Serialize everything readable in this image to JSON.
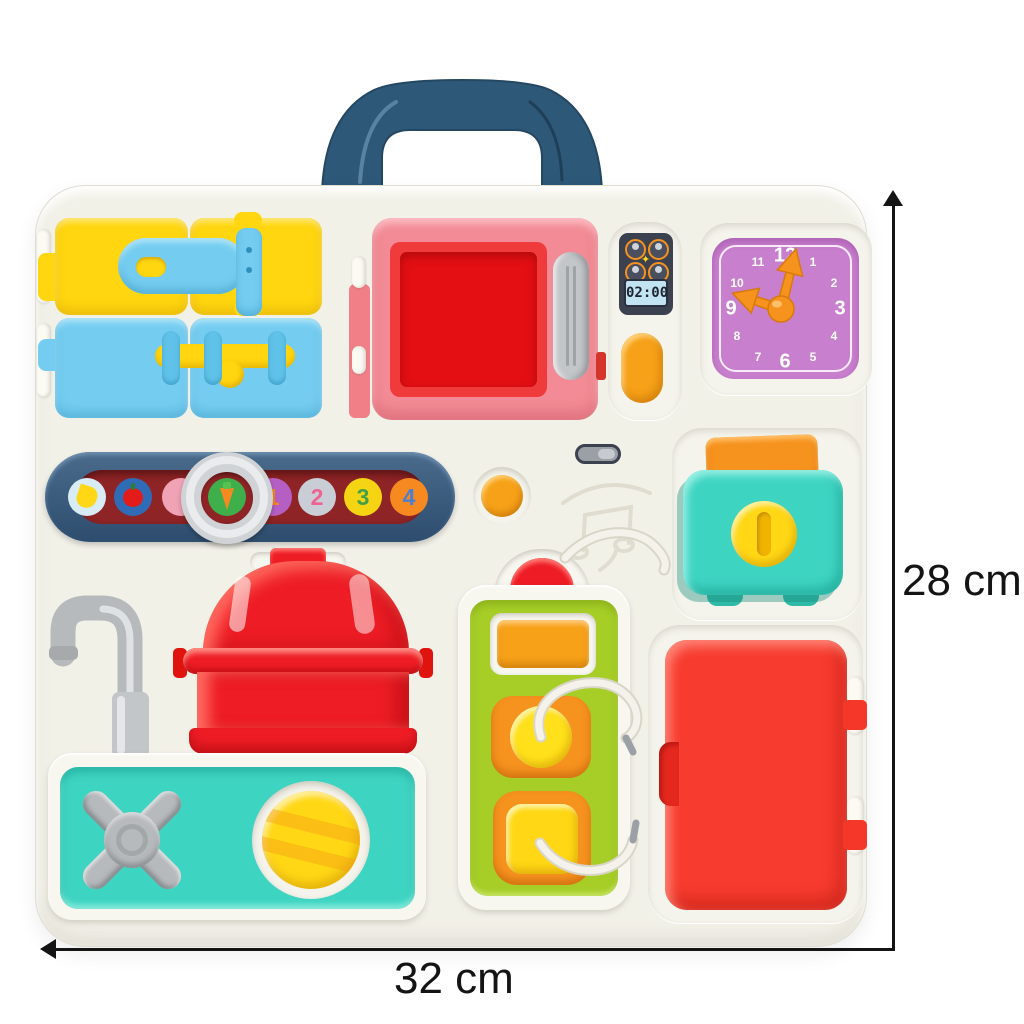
{
  "annotations": {
    "height_label": "28 cm",
    "width_label": "32 cm"
  },
  "modules": {
    "clock": {
      "numbers": [
        "12",
        "1",
        "2",
        "3",
        "4",
        "5",
        "6",
        "7",
        "8",
        "9",
        "10",
        "11"
      ],
      "face_color": "#c87fcd",
      "hands_color": "#f6921e",
      "hour_hand_points_to": "9",
      "minute_hand_points_to": "12"
    },
    "microwave": {
      "display_time": "02:00",
      "frame_color": "#f28b95",
      "door_color": "#e81c23",
      "handle_color": "#c3c6c9",
      "icon_buttons": [
        "chicken-icon",
        "drink-icon",
        "egg-icon",
        "fish-icon"
      ],
      "start_button_color": "#f6a118"
    },
    "slider_bar": {
      "items": [
        "banana-icon",
        "apple-icon",
        "pink-blank",
        "carrot-icon",
        "1",
        "2",
        "3",
        "4"
      ],
      "numerals": [
        "1",
        "2",
        "3",
        "4"
      ],
      "track_color": "#8e2426",
      "frame_color": "#3a5a7a",
      "ring_color": "#cfd3d6"
    },
    "toaster": {
      "body_color": "#3ed4c2",
      "toast_color": "#f6921e",
      "knob_color": "#ffd715"
    },
    "doors": {
      "yellow": "#ffd60f",
      "blue": "#74cdf0",
      "latch_blue": "#74cdf0",
      "bolt_yellow": "#ffd60f"
    },
    "pot": {
      "color": "#ee1c25"
    },
    "sink": {
      "panel_color": "#3ed4c2",
      "tap_color": "#b7babd",
      "knob_color": "#ffd715",
      "faucet_color": "#b7babd"
    },
    "activity_panel": {
      "panel_color": "#a6ce27",
      "button_colors": [
        "#f6a118",
        "#ffe01a",
        "#ffd715"
      ],
      "cord_color": "#f4f2ea",
      "dome_button_color": "#ee1c25"
    },
    "fridge": {
      "door_color": "#f73b2e"
    }
  },
  "colors": {
    "board": "#f2f1e8",
    "handle": "#2e5878",
    "background": "#ffffff",
    "dimension_lines": "#141414"
  }
}
